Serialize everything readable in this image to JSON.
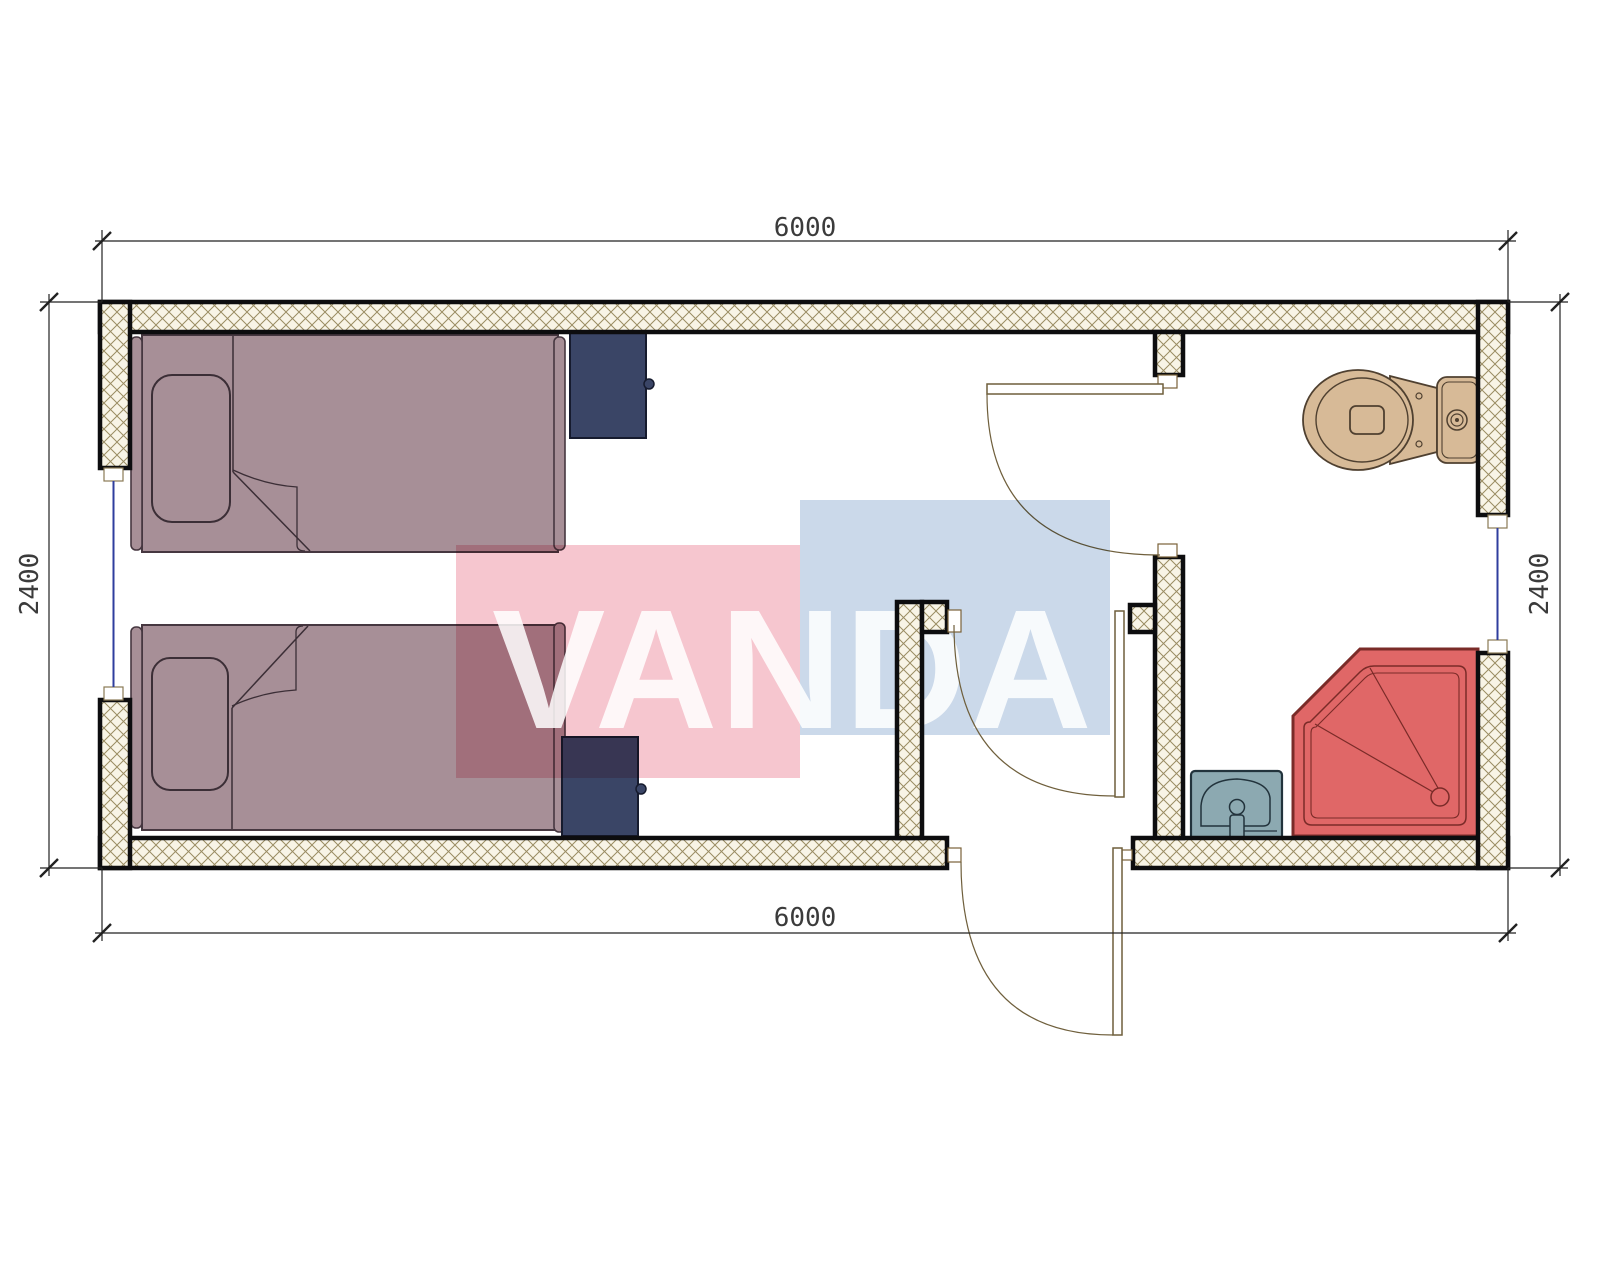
{
  "watermark": {
    "text": "VANDA",
    "pink_color": "#F6C6CF",
    "blue_color": "#CBD9EA",
    "text_color": "#FFFFFF"
  },
  "dimensions": {
    "top": {
      "label": "6000"
    },
    "bottom": {
      "label": "6000"
    },
    "left": {
      "label": "2400"
    },
    "right": {
      "label": "2400"
    }
  },
  "plan": {
    "type": "floor-plan",
    "wall_color": "#0d0d0f",
    "hatch_background": "#F8F4E6",
    "hatch_line_color": "#9A8C62",
    "window_glass_color": "#2F3E9E",
    "door_swing_color": "#6F5F3C",
    "dimension_line_color": "#222222",
    "furniture": [
      {
        "name": "bed-top",
        "color": "#A78F97"
      },
      {
        "name": "bed-bottom",
        "color": "#A78F97"
      },
      {
        "name": "nightstand-top",
        "color": "#3A4566"
      },
      {
        "name": "nightstand-bottom",
        "color": "#3A4566"
      },
      {
        "name": "toilet",
        "color": "#D7BA97"
      },
      {
        "name": "shower-tray",
        "color": "#E06767"
      },
      {
        "name": "sink",
        "color": "#8CA9B1"
      }
    ],
    "openings": [
      "window-left-wall",
      "window-right-wall",
      "door-bathroom",
      "door-hallway",
      "door-exterior"
    ]
  }
}
